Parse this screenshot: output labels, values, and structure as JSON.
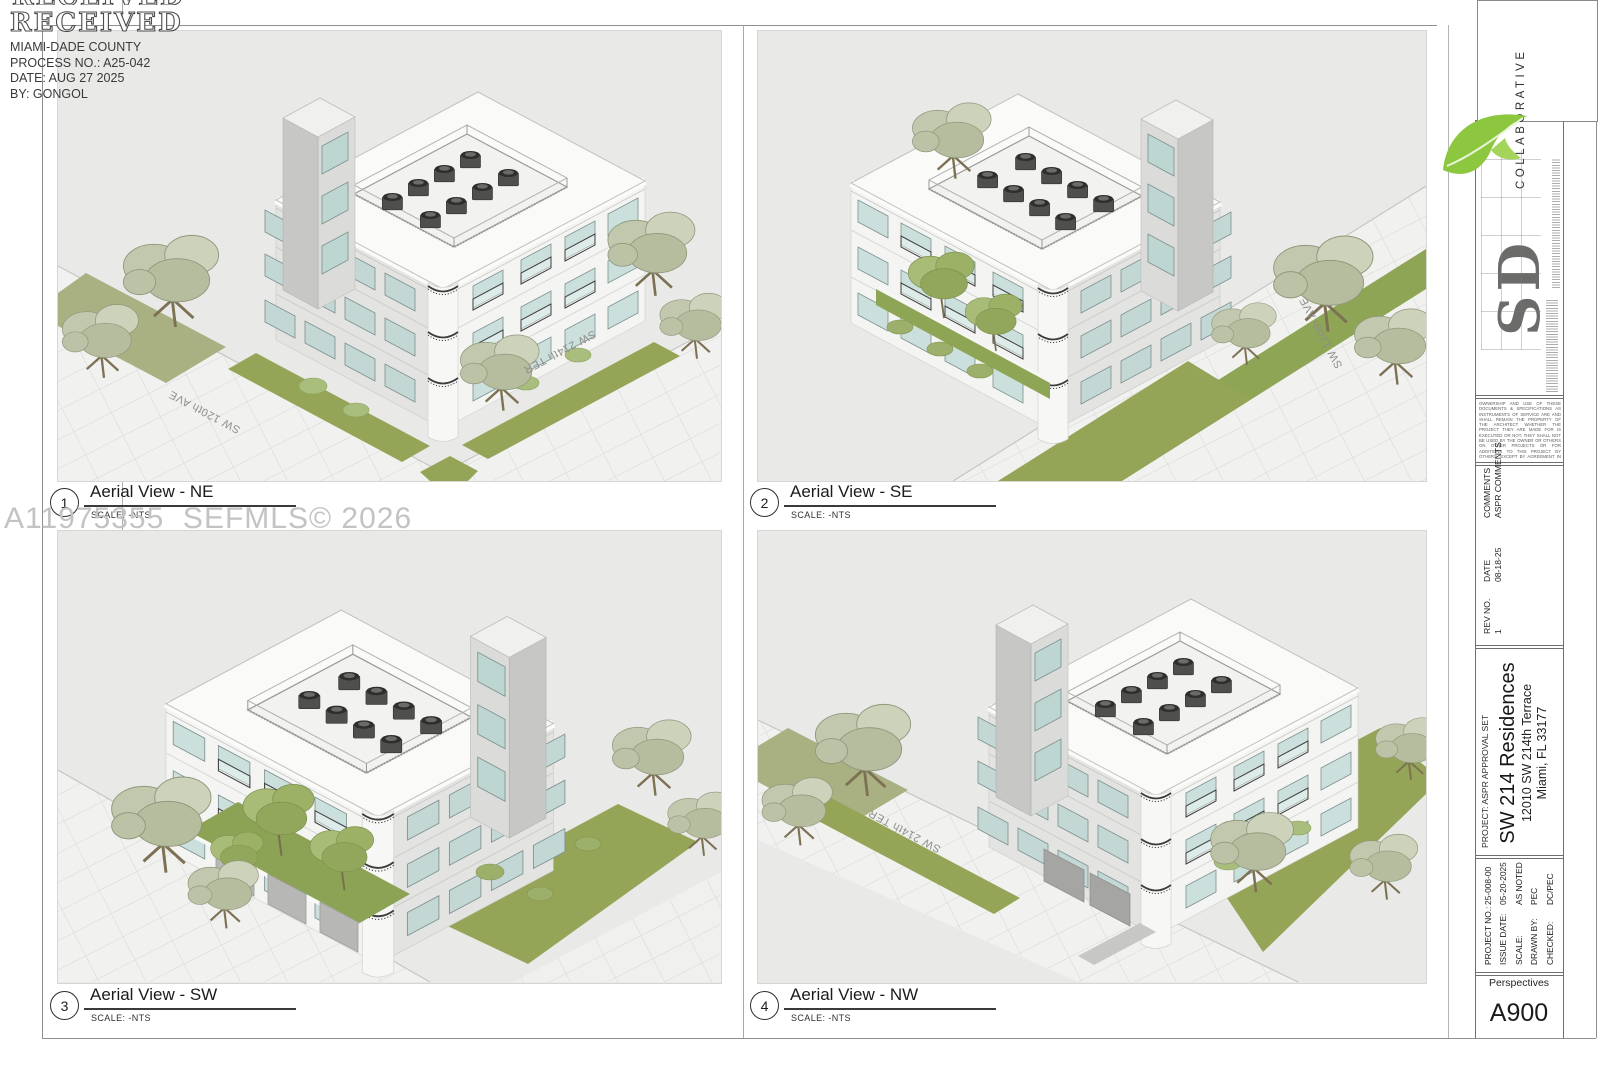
{
  "stamp": {
    "received": "RECEIVED",
    "lines": [
      "MIAMI-DADE COUNTY",
      "PROCESS NO.: A25-042",
      "DATE: AUG 27 2025",
      "BY: GONGOL"
    ]
  },
  "watermark": "A11975355  SEFMLS© 2026",
  "views": [
    {
      "number": "1",
      "title": "Aerial View - NE",
      "scale": "SCALE: -NTS",
      "street_labels": [
        "SW 120th AVE",
        "SW 214th TER"
      ]
    },
    {
      "number": "2",
      "title": "Aerial View - SE",
      "scale": "SCALE: -NTS",
      "street_labels": [
        "SW 120th AVE"
      ]
    },
    {
      "number": "3",
      "title": "Aerial View - SW",
      "scale": "SCALE: -NTS",
      "street_labels": []
    },
    {
      "number": "4",
      "title": "Aerial View - NW",
      "scale": "SCALE: -NTS",
      "street_labels": [
        "SW 214th TER"
      ]
    }
  ],
  "titleblock": {
    "logo": {
      "letters": "SD",
      "company": "COLLABORATIVE"
    },
    "disclaimer": "OWNERSHIP AND USE OF THESE DOCUMENTS & SPECIFICATIONS AS INSTRUMENTS OF SERVICE ARE AND SHALL REMAIN THE PROPERTY OF THE ARCHITECT WHETHER THE PROJECT THEY ARE MADE FOR IS EXECUTED OR NOT. THEY SHALL NOT BE USED BY THE OWNER OR OTHERS ON OTHER PROJECTS OR FOR ADDITIONS TO THIS PROJECT BY OTHERS, EXCEPT BY AGREEMENT IN WRITING AND WITH APPROPRIATE COMPENSATION TO THE ARCHITECT.",
    "revisions": {
      "rev_no_label": "REV NO.",
      "date_label": "DATE",
      "comments_label": "COMMENTS",
      "rows": [
        {
          "rev": "1",
          "date": "08-18-25",
          "comment": "ASPR COMMENTS"
        }
      ]
    },
    "project": {
      "label": "PROJECT: ASPR APPROVAL SET",
      "name": "SW 214 Residences",
      "address_line1": "12010 SW 214th Terrace",
      "address_line2": "Miami, FL 33177"
    },
    "info": [
      {
        "label": "PROJECT NO.:",
        "value": "25-008-00"
      },
      {
        "label": "ISSUE DATE:",
        "value": "05-20-2025"
      },
      {
        "label": "SCALE:",
        "value": "AS NOTED"
      },
      {
        "label": "DRAWN BY:",
        "value": "PEC"
      },
      {
        "label": "CHECKED:",
        "value": "DC/PEC"
      }
    ],
    "sheet_title": "Perspectives",
    "sheet_number": "A900"
  },
  "colors": {
    "panel_bg": "#e9e9e8",
    "lawn_green": "#95a557",
    "sage_green": "#a9b183",
    "window_teal": "#cbe0dd",
    "leaf_green": "#8dc63f",
    "watermark_gray": "#c3c3c3",
    "line_dark": "#3a3a3a"
  }
}
